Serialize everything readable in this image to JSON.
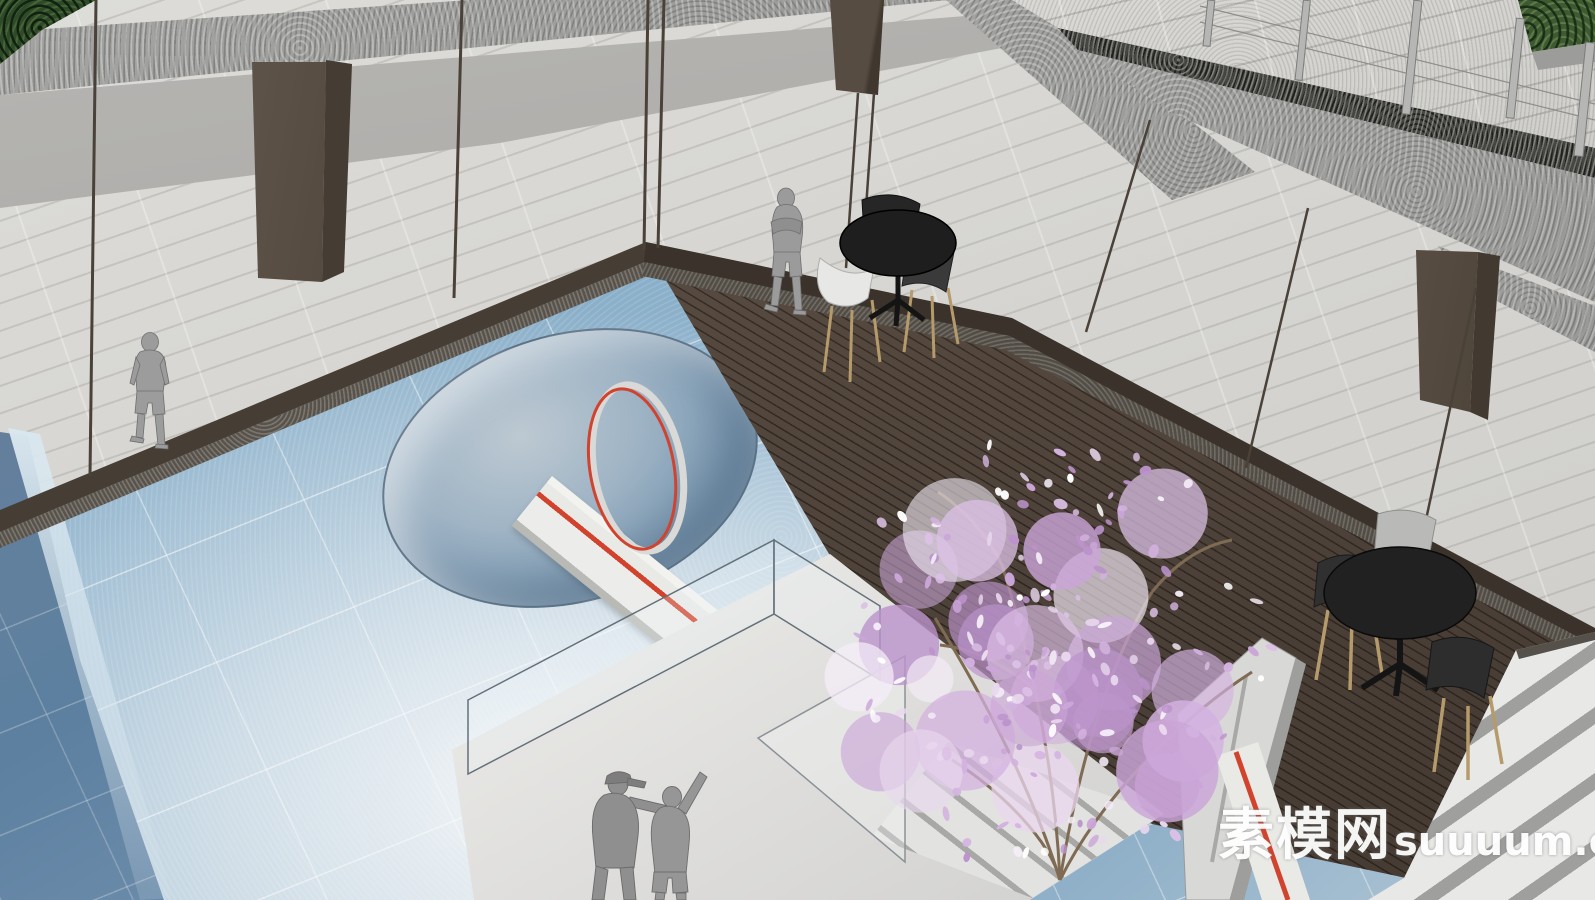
{
  "meta": {
    "width_px": 1595,
    "height_px": 900,
    "type": "3d-architectural-rendering",
    "style": "SketchUp-like courtyard pool visualization, aerial oblique view"
  },
  "watermark": {
    "cjk": "素模网",
    "latin": "suuuum.com",
    "full": "素模网suuuum.com"
  },
  "colors": {
    "floor_plank": "#d7d6d2",
    "wall_gray": "#aeadaa",
    "fascia_concrete": "#9c9c9a",
    "terrace_paving": "#d4d3cf",
    "gravel_dark": "#454541",
    "hedge_green": "#3f5a33",
    "foliage_dark": "#2f4a2a",
    "column_brown": "#574c41",
    "mullion_brown": "#4a4138",
    "deck_brown": "#4e433b",
    "deck_trim": "#3a322b",
    "pool_light": "#8fb3cc",
    "pool_deep": "#5d80a0",
    "crater_inner": "#7e9cb5",
    "walkway_white": "#ececea",
    "red_accent": "#d2432e",
    "platform_white": "#e3e3e1",
    "glass_tint": "#e8f1f5",
    "slab_gray": "#d8d8d6",
    "slab_side": "#9e9e9c",
    "table_black": "#1e1e1e",
    "chair_dark": "#343434",
    "chair_white": "#e7e7e5",
    "chair_gray": "#b9b9b7",
    "leg_tan": "#b59a6b",
    "figure_gray": "#9b9b9b",
    "figure_outline": "#6f6f6f",
    "stairs_tread": "#e8e8e6",
    "stairs_riser": "#9f9f9d",
    "branch_brown": "#7f6b53",
    "railing_post": "#b6b6b4",
    "watermark": "#ffffff"
  },
  "scene": {
    "elements": [
      "glass curtain wall with dark mullions",
      "granite concrete fascia bands",
      "upper terrace with cable railing posts",
      "hedge planter at top-right",
      "dark wood plank deck",
      "two cafe table sets with chairs",
      "sunken blue-tile pool with circular crater",
      "white walkway with red stripe and glass balustrade",
      "upright ring sculpture",
      "cherry-blossom tree",
      "white slab sculpture",
      "wide stairs at bottom-right",
      "white viewing platform with glass pane"
    ],
    "figures": [
      {
        "name": "walking-person",
        "pose": "walking indoors behind glass, far left"
      },
      {
        "name": "standing-person",
        "pose": "standing on deck, arms crossed, near table set"
      },
      {
        "name": "pointing-man",
        "pose": "on platform, cap, pointing right"
      },
      {
        "name": "waving-woman",
        "pose": "on platform, arm raised"
      }
    ],
    "furniture": {
      "table_set_1": {
        "table": "round black pedestal table",
        "chairs": [
          "white shell chair",
          "dark shell chair",
          "black chair behind"
        ]
      },
      "table_set_2": {
        "table": "round black pedestal table",
        "chairs": [
          "gray shell chair",
          "dark shell chair left",
          "dark shell chair front"
        ]
      }
    },
    "tree": {
      "cx": 1055,
      "cy": 655,
      "rx": 215,
      "ry": 190,
      "seed": 11,
      "cluster_count": 26,
      "petal_count": 185,
      "palette": [
        "#e9d7ee",
        "#dcc0e5",
        "#cba6d8",
        "#bb93cb",
        "#f4ecf7",
        "#d3b2e0"
      ],
      "white_accent": "#ffffff",
      "branch_color": "#7f6b53"
    }
  }
}
